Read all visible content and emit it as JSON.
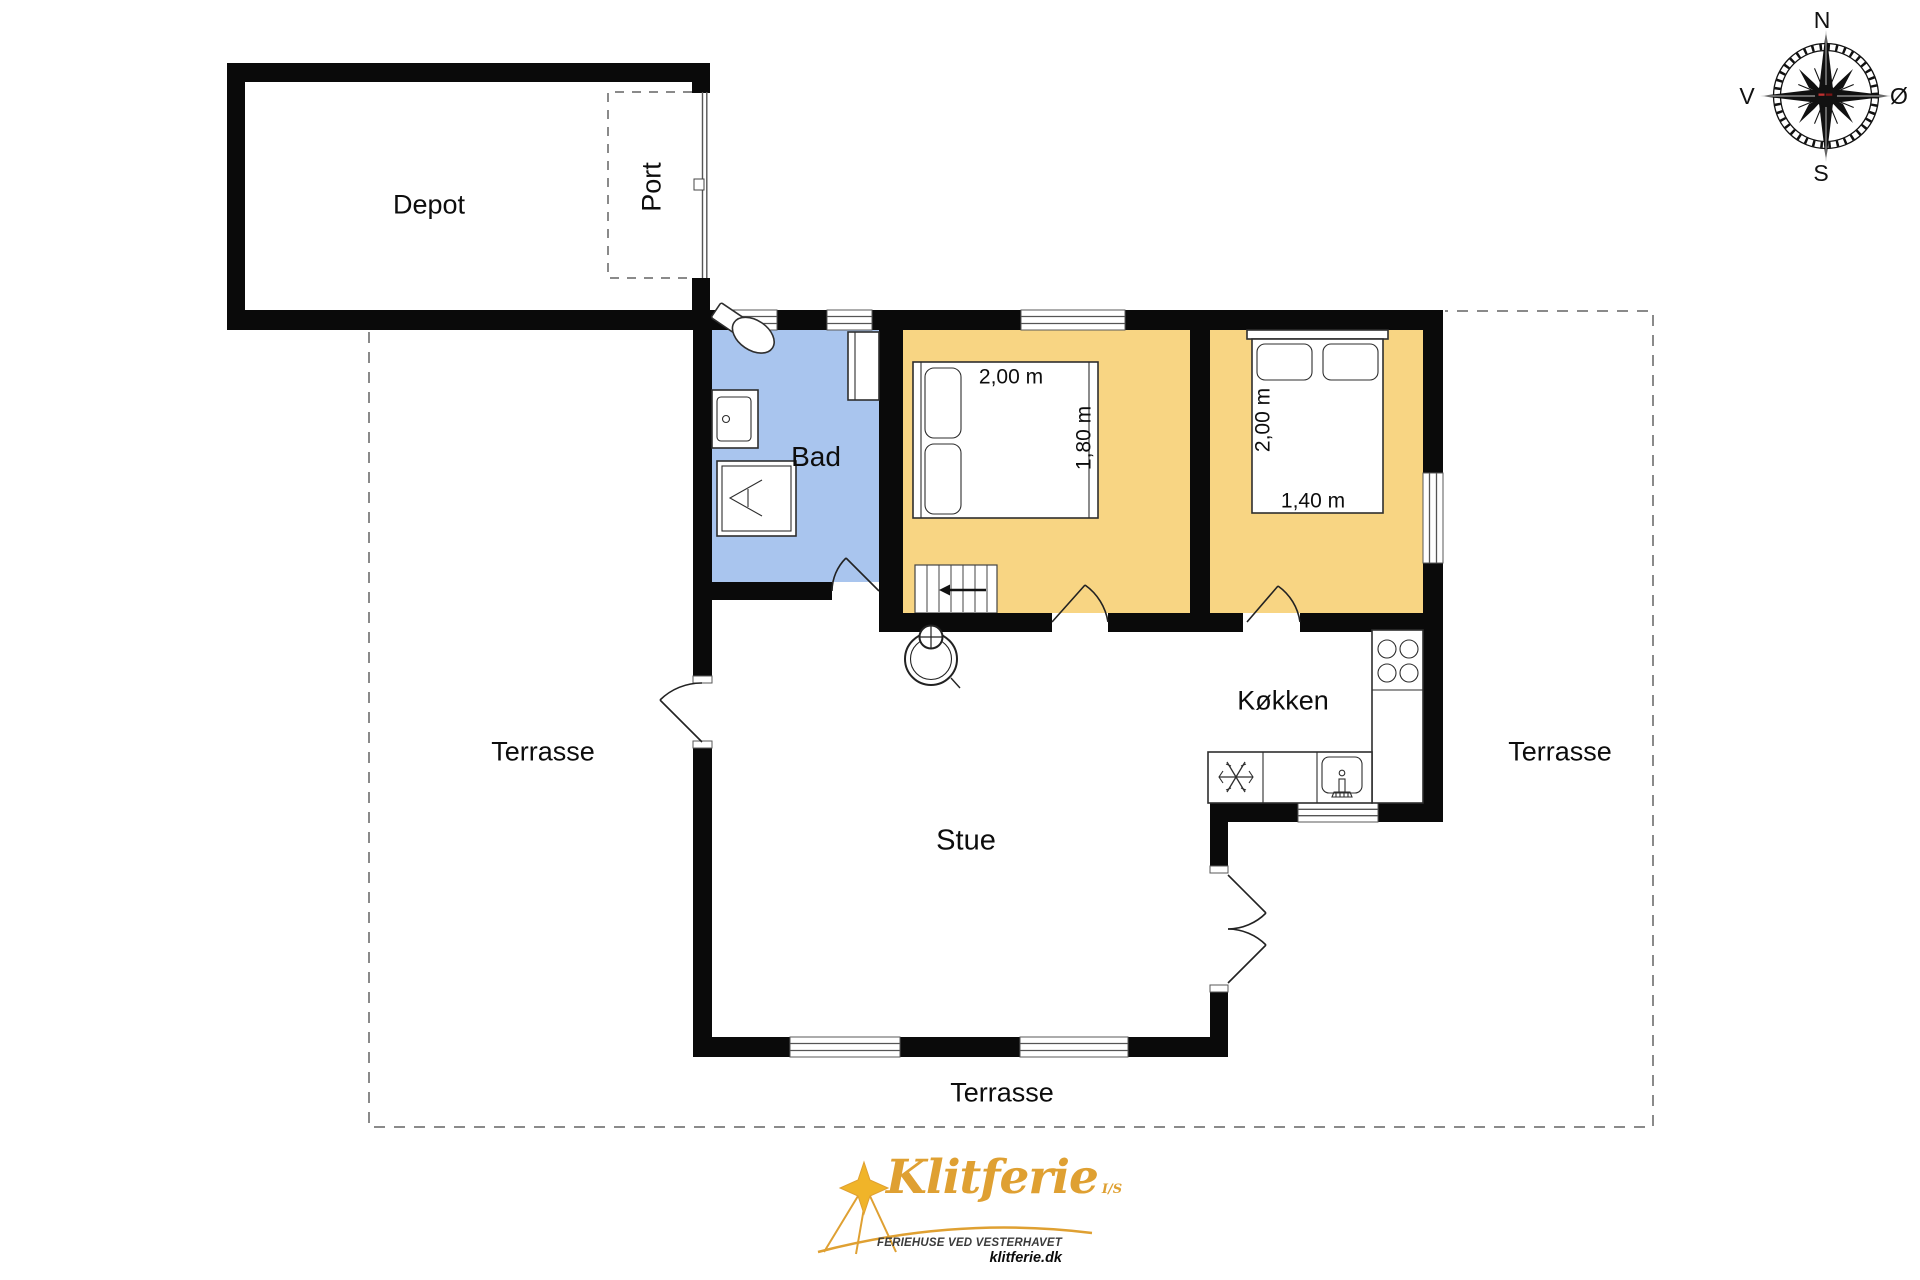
{
  "plan": {
    "rooms": {
      "depot": "Depot",
      "port": "Port",
      "bad": "Bad",
      "kokken": "Køkken",
      "stue": "Stue",
      "terrasse": "Terrasse"
    },
    "bedroom1": {
      "bed_length": "2,00 m",
      "bed_width": "1,80 m"
    },
    "bedroom2": {
      "bed_length": "2,00 m",
      "bed_width": "1,40 m"
    }
  },
  "compass": {
    "north": "N",
    "east": "Ø",
    "south": "S",
    "west": "V"
  },
  "logo": {
    "brand": "Klitferie",
    "company_suffix": "I/S",
    "tagline": "FERIEHUSE VED VESTERHAVET",
    "website": "klitferie.dk"
  },
  "colors": {
    "bedroom": "#F8D583",
    "bath": "#A9C5EE",
    "wall": "#0A0A0A",
    "gold": "#DFA032",
    "dash": "#8A8A8A"
  }
}
